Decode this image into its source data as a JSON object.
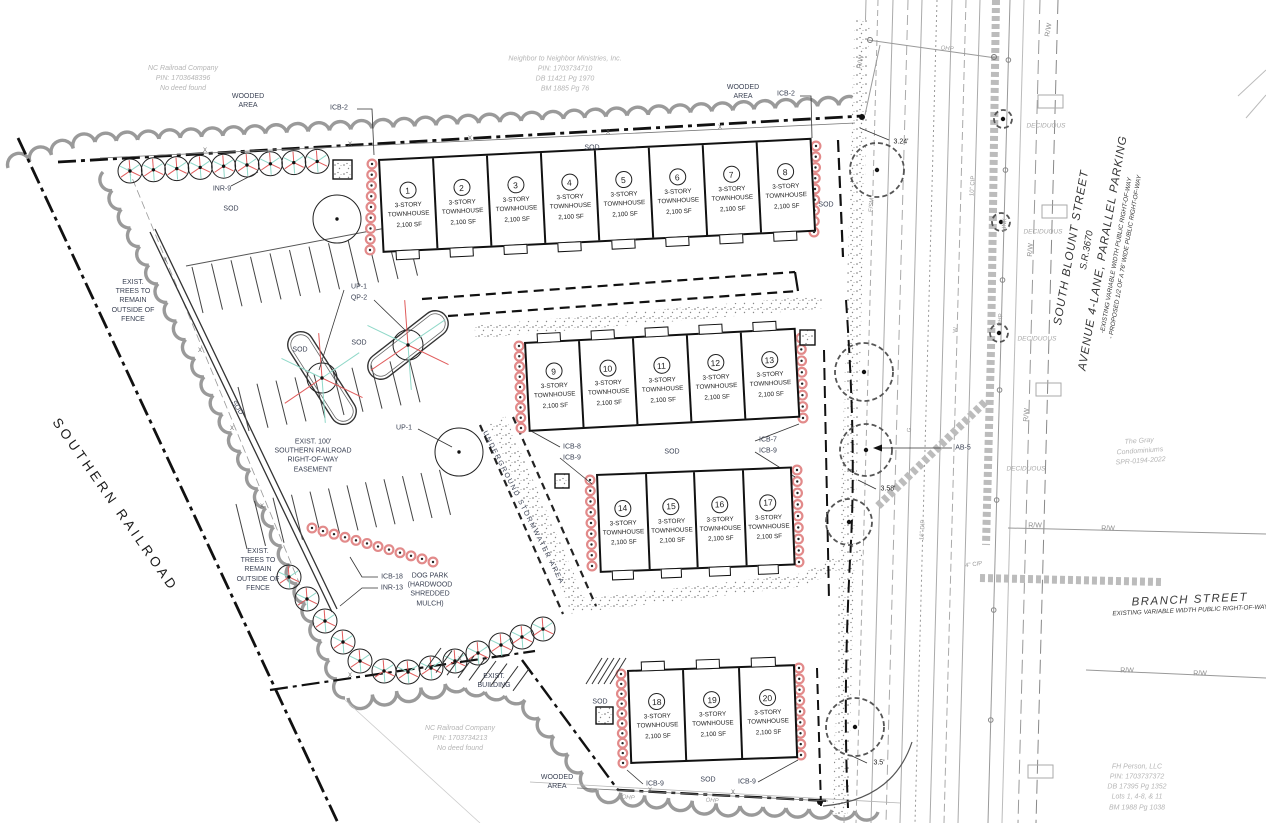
{
  "units": {
    "type_line1": "3-STORY",
    "type_line2": "TOWNHOUSE",
    "size": "2,100 SF",
    "numbers": [
      "1",
      "2",
      "3",
      "4",
      "5",
      "6",
      "7",
      "8",
      "9",
      "10",
      "11",
      "12",
      "13",
      "14",
      "15",
      "16",
      "17",
      "18",
      "19",
      "20"
    ]
  },
  "streets": {
    "south_blount": [
      "SOUTH BLOUNT STREET",
      "S.R.3670",
      "AVENUE 4-LANE, PARALLEL PARKING",
      "-EXISTING VARIABLE WIDTH PUBLIC  RIGHT-OF-WAY",
      "- PROPOSED 1/2 OF A 76' WIDE PUBLIC RIGHT-OF-WAY"
    ],
    "branch": [
      "BRANCH STREET",
      "EXISTING VARIABLE WIDTH PUBLIC  RIGHT-OF-WAY"
    ],
    "southern_railroad": "SOUTHERN RAILROAD"
  },
  "parcels": {
    "nc_railroad_north": [
      "NC Railroad Company",
      "PIN: 1703648396",
      "No deed found"
    ],
    "neighbor_ministries": [
      "Neighbor to Neighbor Ministries, Inc.",
      "PIN: 1703734710",
      "DB 11421 Pg 1970",
      "BM 1885 Pg 76"
    ],
    "nc_railroad_south": [
      "NC Railroad Company",
      "PIN: 1703734213",
      "No deed found"
    ],
    "fh_person": [
      "FH Person, LLC",
      "PIN: 1703737372",
      "DB 17395 Pg 1352",
      "Lots 1, 4-8, & 11",
      "BM 1988 Pg 1038"
    ],
    "gray_condominiums": [
      "The Gray",
      "Condominiums",
      "SPR-0194-2022"
    ]
  },
  "labels": {
    "sod": "SOD",
    "wooded_area": [
      "WOODED",
      "AREA"
    ],
    "icb2": "ICB-2",
    "inr9": "INR-9",
    "up1": "UP-1",
    "qp2": "QP-2",
    "icb8": "ICB-8",
    "icb9": "ICB-9",
    "icb7": "ICB-7",
    "icb18": "ICB-18",
    "inr13": "INR-13",
    "ab5": "AB-5",
    "exist_trees": [
      "EXIST.",
      "TREES TO",
      "REMAIN",
      "OUTSIDE OF",
      "FENCE"
    ],
    "easement": [
      "EXIST. 100'",
      "SOUTHERN RAILROAD",
      "RIGHT-OF-WAY",
      "EASEMENT"
    ],
    "dog_park": [
      "DOG PARK",
      "(HARDWOOD",
      "SHREDDED",
      "MULCH)"
    ],
    "exist_building": [
      "EXIST.",
      "BUILDING"
    ],
    "underground_stormwater": "UNDERGROUND STORMWATER AREA",
    "deciduous": "DECIDUOUS",
    "rw": "R/W",
    "ohp": "OHP",
    "x_mark": "X",
    "utilities": [
      "F/SM",
      "W",
      "G",
      "LINK",
      "OHP",
      "10\" CIP",
      "16\" DIP",
      "4\" CIP"
    ]
  },
  "dimensions": {
    "d1": "3.24'",
    "d2": "3.58'",
    "d3": "3.5'"
  }
}
